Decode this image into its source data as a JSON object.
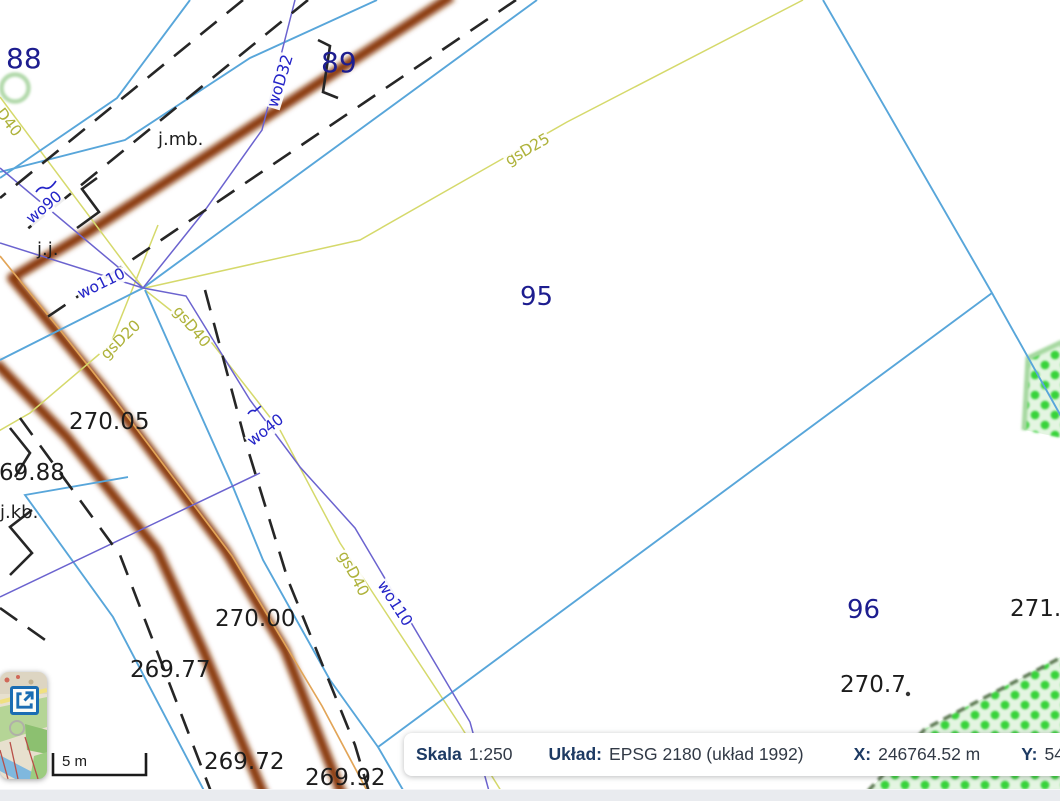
{
  "map": {
    "parcels": [
      {
        "id": "88"
      },
      {
        "id": "89"
      },
      {
        "id": "95"
      },
      {
        "id": "96"
      }
    ],
    "utilities": [
      {
        "text": "woD32",
        "kind": "water"
      },
      {
        "text": "wo90",
        "kind": "water"
      },
      {
        "text": "wo110",
        "kind": "water"
      },
      {
        "text": "wo40",
        "kind": "water"
      },
      {
        "text": "wo110",
        "kind": "water"
      },
      {
        "text": "gsD25",
        "kind": "gas"
      },
      {
        "text": "D40",
        "kind": "gas"
      },
      {
        "text": "gsD20",
        "kind": "gas"
      },
      {
        "text": "gsD40",
        "kind": "gas"
      },
      {
        "text": "gsD40",
        "kind": "gas"
      }
    ],
    "elevations": [
      {
        "text": "270.05"
      },
      {
        "text": "69.88"
      },
      {
        "text": "270.00"
      },
      {
        "text": "269.77"
      },
      {
        "text": "269.72"
      },
      {
        "text": "269.92"
      },
      {
        "text": "271.2"
      },
      {
        "text": "270.7"
      }
    ],
    "annotations": [
      {
        "text": "j.mb."
      },
      {
        "text": "j.j."
      },
      {
        "text": "j.kb."
      }
    ]
  },
  "scalebar": {
    "label": "5 m"
  },
  "statusbar": {
    "scale_label": "Skala",
    "scale_value": "1:250",
    "crs_label": "Układ:",
    "crs_value": "EPSG 2180 (układ 1992)",
    "x_label": "X:",
    "x_value": "246764.52 m",
    "y_label": "Y:",
    "y_value": "548"
  },
  "minimap": {
    "expand_icon": "open-in-new-window-icon"
  },
  "colors": {
    "parcel_number": "#1d1d8f",
    "water_label": "#2424c8",
    "gas_label": "#aeb23a",
    "parcel_line": "#58a6da",
    "water_line": "#6b63cf",
    "gas_line": "#d5d96b",
    "road_line": "#8a3a10",
    "orange_line": "#e2a558",
    "vegetation_dot": "#38d33b",
    "statusbar_label": "#1d3a63"
  }
}
